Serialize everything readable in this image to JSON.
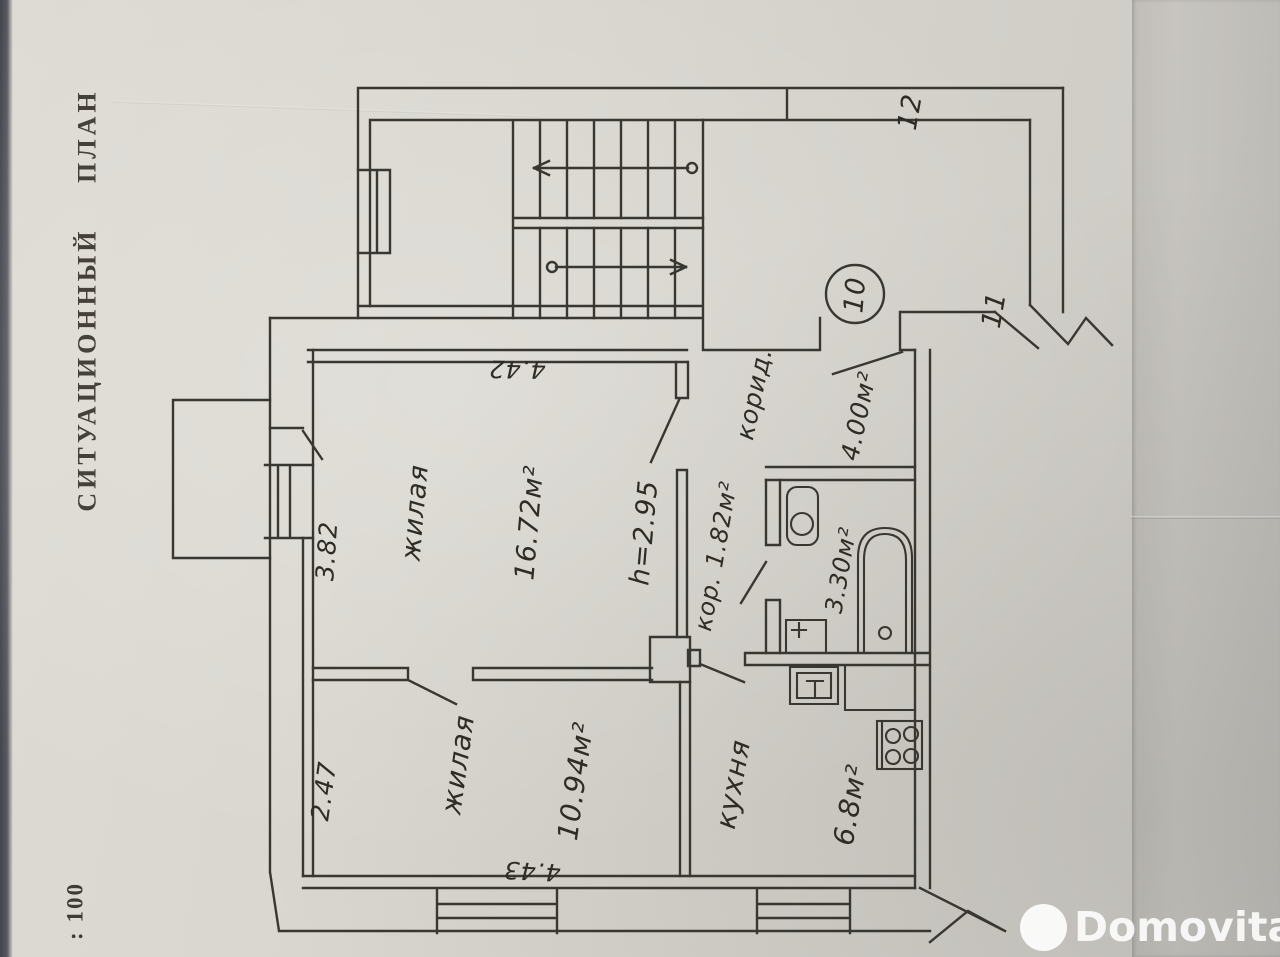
{
  "document": {
    "title": "СИТУАЦИОННЫЙ ПЛАН",
    "scale": ": 100"
  },
  "plan": {
    "rooms": {
      "living_main": {
        "name": "жилая",
        "area": "16.72м²",
        "ceiling_height": "h=2.95"
      },
      "living_second": {
        "name": "жилая",
        "area": "10.94м²"
      },
      "kitchen": {
        "name": "кухня",
        "area": "6.8м²"
      },
      "corridor": {
        "name": "корид.",
        "area": "4.00м²"
      },
      "hallway": {
        "label": "кор. 1.82м²"
      },
      "bathroom": {
        "area": "3.30м²"
      }
    },
    "dimensions": {
      "top": "4.42",
      "left_upper": "3.82",
      "left_lower": "2.47",
      "bottom": "4.43"
    },
    "markers": {
      "apartment_number": "10",
      "wall_upper": "12",
      "wall_lower": "11"
    }
  },
  "watermark": {
    "brand": "Domovita"
  }
}
